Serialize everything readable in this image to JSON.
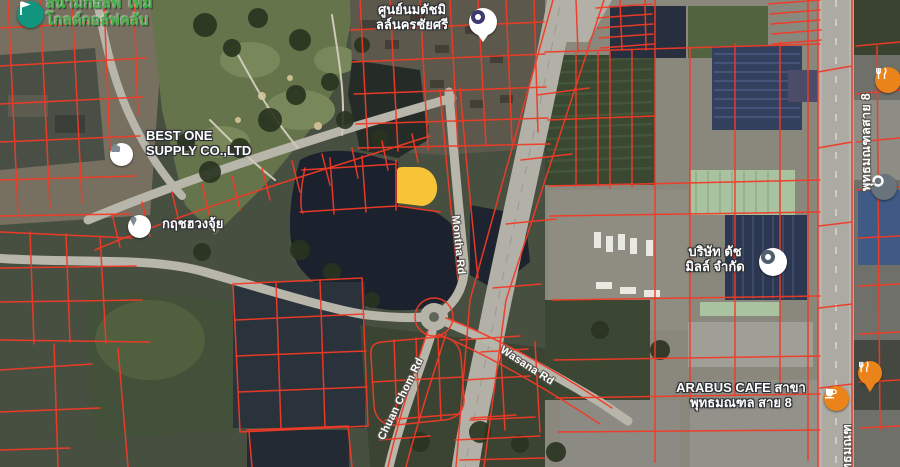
{
  "map": {
    "type": "satellite-with-cadastral-overlay",
    "colors": {
      "parcel_line": "#f23a26",
      "highlight_parcel": "#f8c437",
      "road_fill": "#b3b1a7",
      "water": "#1b222e",
      "golf_green": "#66744c",
      "poi_orange": "#ea8319",
      "golf_label_green": "#46b04a"
    },
    "labels": {
      "golf_club": {
        "line1": "สนามกอล์ฟ ใหม่",
        "line2": "โกลด์กอล์ฟคลับ"
      },
      "best_one": {
        "line1": "BEST ONE",
        "line2": "SUPPLY CO.,LTD"
      },
      "krit_fengshui": {
        "text": "กฤชฮวงจุ้ย"
      },
      "dutch_mill_center": {
        "line1": "ศูนย์นมดัชมิ",
        "line2": "ลล์นครชัยศรี"
      },
      "dutch_mill_co": {
        "line1": "บริษัท ดัช",
        "line2": "มิลล์ จำกัด"
      },
      "arabus_cafe": {
        "line1": "ARABUS CAFE สาขา",
        "line2": "พุทธมณฑล สาย 8"
      }
    },
    "roads": {
      "montha": "Montha Rd",
      "wasana": "Wasana Rd",
      "chuan_chom": "Chuan Chom Rd",
      "sai8": "พุทธมณฑลสาย 8",
      "sai8_partial": "พุทธมณฑ"
    },
    "icons": [
      "golf-flag-icon",
      "place-pin-icon",
      "place-pin-icon",
      "dairy-center-pin-icon",
      "factory-pin-icon",
      "coffee-icon",
      "restaurant-icon",
      "restaurant-pin-icon",
      "poi-ring-icon"
    ]
  }
}
